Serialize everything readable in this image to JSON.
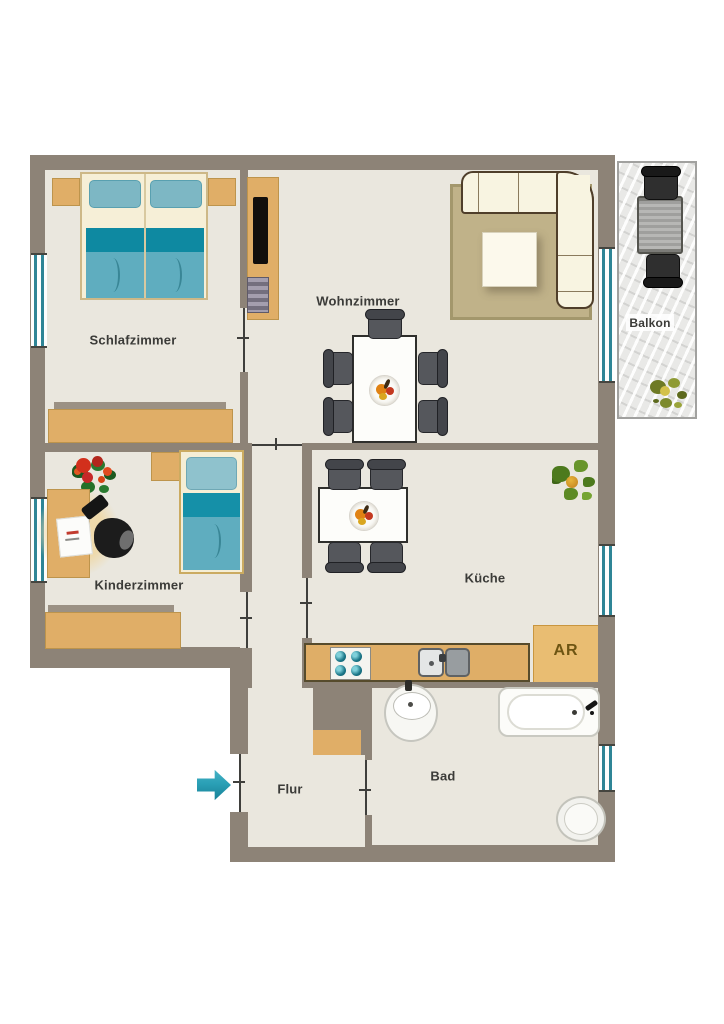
{
  "plan": {
    "rooms": {
      "schlafzimmer": "Schlafzimmer",
      "wohnzimmer": "Wohnzimmer",
      "kinderzimmer": "Kinderzimmer",
      "kueche": "Küche",
      "bad": "Bad",
      "flur": "Flur",
      "balkon": "Balkon",
      "abstellraum": "AR"
    },
    "icons": {
      "entrance_arrow": "➤"
    },
    "colors": {
      "wall": "#8d8377",
      "floor": "#eae7de",
      "wood": "#e0ae67",
      "teal_dark": "#0e89a1",
      "teal_light": "#5fadbf",
      "window_teal": "#2e8596",
      "arrow_teal": "#2ba0b6"
    }
  }
}
